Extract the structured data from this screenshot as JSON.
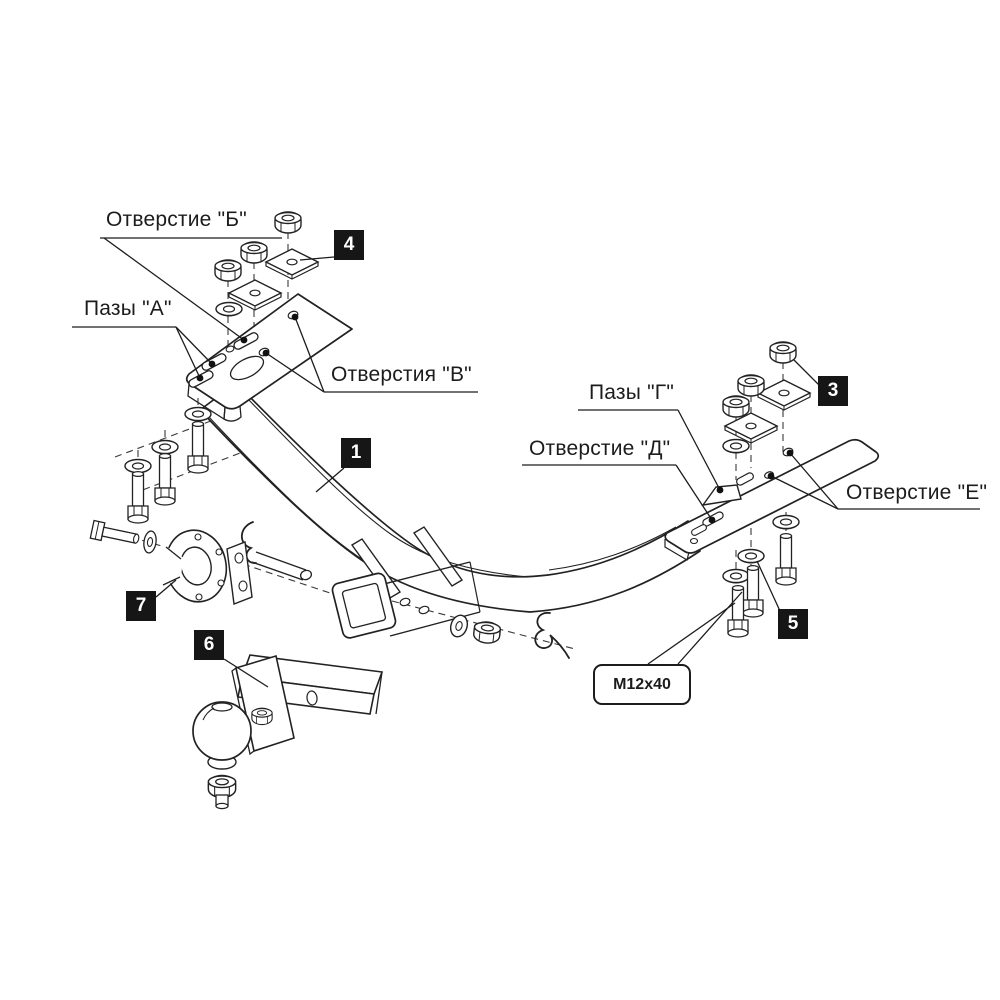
{
  "colors": {
    "background": "#ffffff",
    "line": "#222222",
    "badge_bg": "#161616",
    "badge_fg": "#ffffff"
  },
  "callouts": {
    "hole_b": "Отверстие \"Б\"",
    "slots_a": "Пазы \"А\"",
    "holes_v": "Отверстия \"В\"",
    "slots_g": "Пазы \"Г\"",
    "hole_d": "Отверстие \"Д\"",
    "hole_e": "Отверстие \"Е\""
  },
  "bolt_label": "M12x40",
  "part_badges": {
    "crossbar": "1",
    "nut_plate_right": "3",
    "nut_plate_left": "4",
    "bolt_washer": "5",
    "ball_mount": "6",
    "socket_bracket": "7"
  }
}
